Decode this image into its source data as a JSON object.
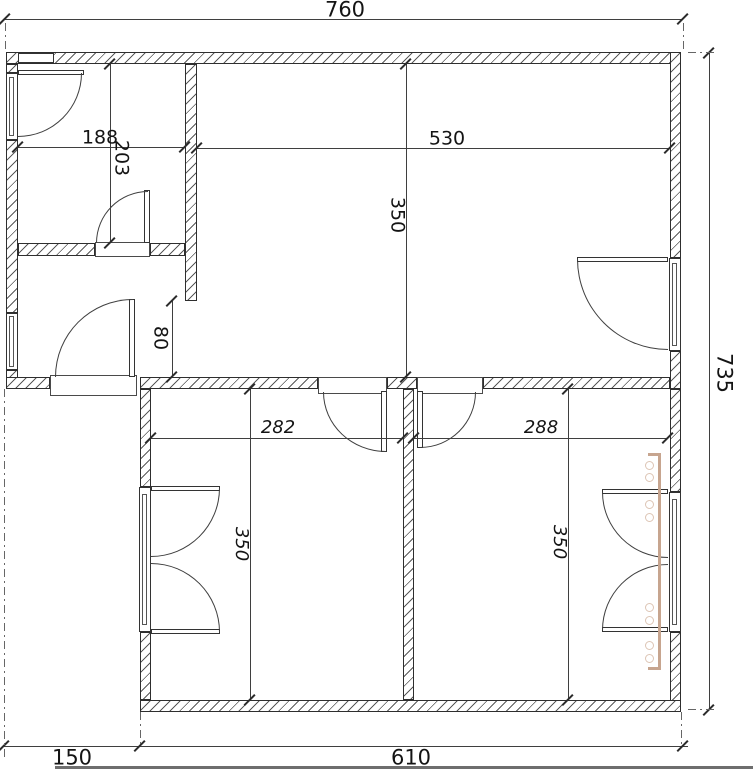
{
  "drawing": {
    "type": "apartment floor plan",
    "units": "cm",
    "colors": {
      "lines": "#3f3f3f",
      "text": "#141414",
      "radiator": "#c7a58f"
    },
    "dims": {
      "overall_width": "760",
      "overall_height": "735",
      "upper_left_width": "188",
      "upper_left_height": "203",
      "living_width": "530",
      "living_depth": "350",
      "passage_width": "80",
      "bedroom_left_width": "282",
      "bedroom_right_width": "288",
      "bedroom_left_depth": "350",
      "bedroom_right_depth": "350",
      "bottom_offset": "150",
      "bottom_width": "610"
    }
  }
}
